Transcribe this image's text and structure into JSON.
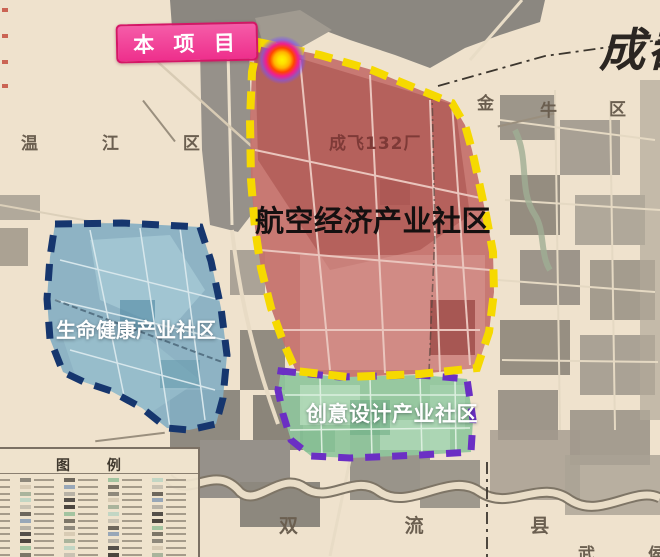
{
  "map": {
    "project_label": "本 项 目",
    "city_label": "成都",
    "factory_label": "成飞132厂",
    "districts": {
      "wenjiang": "温 江 区",
      "jinniu": [
        "金",
        "牛",
        "区"
      ],
      "shuangliu": "双 流 县",
      "wuhou": [
        "武",
        "侯"
      ]
    },
    "zones": {
      "aviation": {
        "label": "航空经济产业社区",
        "fill": "#c5716c",
        "border": "#f6d900"
      },
      "health": {
        "label": "生命健康产业社区",
        "fill": "#83aec3",
        "border": "#16366e"
      },
      "creative": {
        "label": "创意设计产业社区",
        "fill": "#8fc59c",
        "border": "#6b2fc4"
      }
    },
    "legend": {
      "title": "图 例"
    },
    "marker": {
      "core_color": "#ffee00",
      "glow_color": "#7c4dff"
    },
    "project_box_color": "#f03f97",
    "background_color": "#efe2cd"
  }
}
